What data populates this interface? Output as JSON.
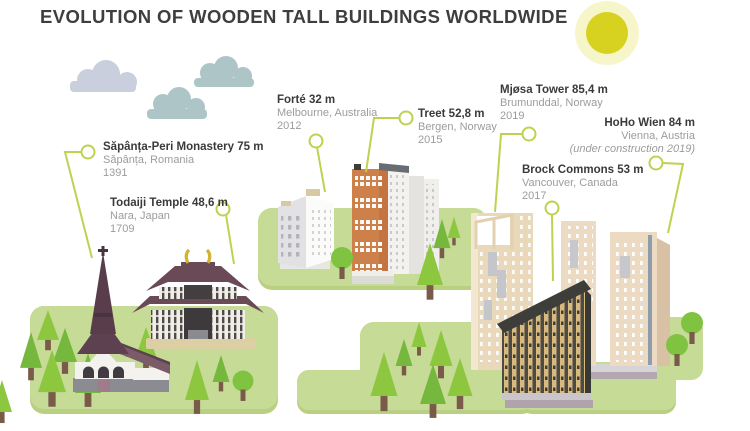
{
  "header": {
    "title": "EVOLUTION OF WOODEN TALL BUILDINGS WORLDWIDE"
  },
  "buildings": [
    {
      "id": "sapanta",
      "name": "Săpânța-Peri Monastery 75 m",
      "location": "Săpânța, Romania",
      "year": "1391"
    },
    {
      "id": "todaiji",
      "name": "Todaiji Temple 48,6 m",
      "location": "Nara, Japan",
      "year": "1709"
    },
    {
      "id": "forte",
      "name": "Forté 32 m",
      "location": "Melbourne, Australia",
      "year": "2012"
    },
    {
      "id": "treet",
      "name": "Treet 52,8 m",
      "location": "Bergen, Norway",
      "year": "2015"
    },
    {
      "id": "mjosa",
      "name": "Mjøsa Tower 85,4 m",
      "location": "Brumunddal, Norway",
      "year": "2019"
    },
    {
      "id": "brock",
      "name": "Brock Commons 53 m",
      "location": "Vancouver, Canada",
      "year": "2017"
    },
    {
      "id": "hoho",
      "name": "HoHo Wien 84 m",
      "location": "Vienna, Austria",
      "year": "(under construction 2019)"
    }
  ],
  "colors": {
    "accent_leader_green": "#bcd34f",
    "hill_green": "#c6db95",
    "hill_shade_green": "#b9d083",
    "sun_yellow": "#d7d21f",
    "sun_halo": "#f7f6cb",
    "title_text": "#3e3e3e",
    "label_text": "#3a3a3a",
    "label_muted": "#9c9c9c"
  },
  "icons": {
    "sun": "sun-icon",
    "cloud": "cloud-icon",
    "pine_tree": "pine-tree-icon",
    "round_tree": "round-tree-icon",
    "marker_dot": "leader-dot-icon"
  }
}
